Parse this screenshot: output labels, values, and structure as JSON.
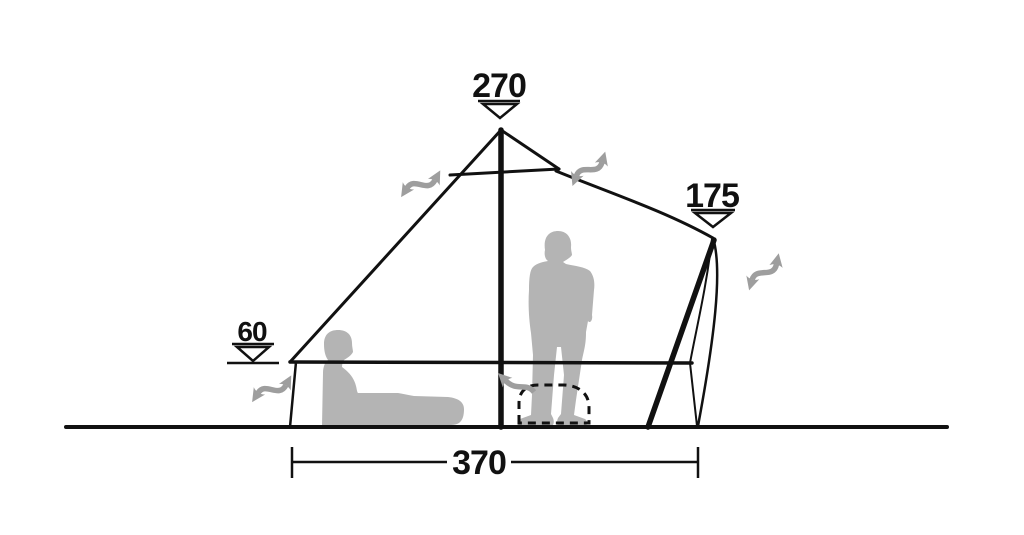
{
  "diagram": {
    "measurements": {
      "peak_height": "270",
      "rear_pole_height": "175",
      "side_wall_height": "60",
      "floor_width": "370"
    },
    "icons": {
      "measure_marker": "triangle-down-icon",
      "airflow": "wavy-double-arrow-icon",
      "vent_door": "dashed-dome-outline",
      "figures": [
        "seated-person-silhouette",
        "standing-person-silhouette"
      ]
    },
    "colors": {
      "line": "#111111",
      "silhouette": "#b4b4b4",
      "arrow": "#9e9e9e",
      "marker_fill": "#ffffff",
      "background": "#ffffff"
    }
  }
}
